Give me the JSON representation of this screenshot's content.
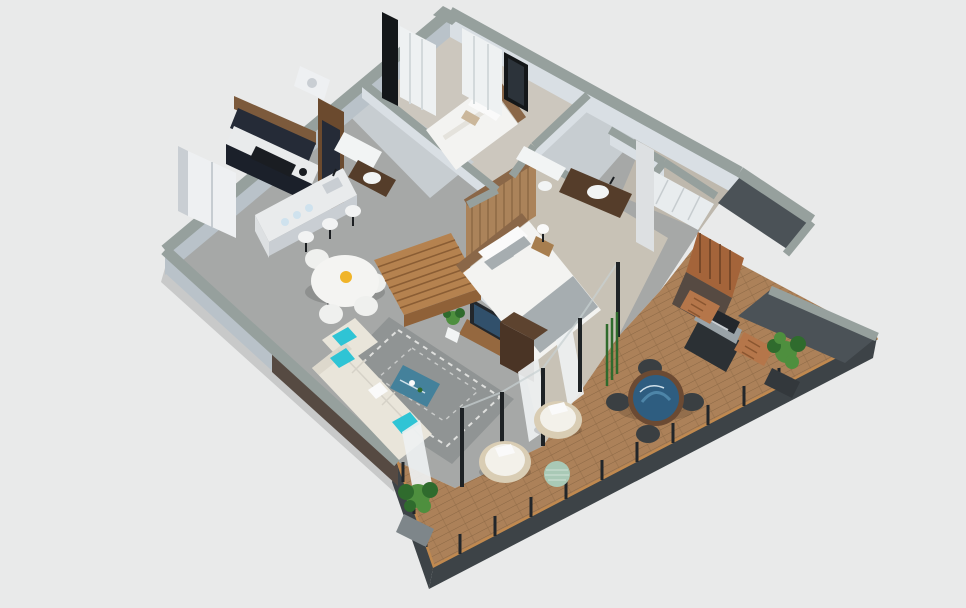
{
  "meta": {
    "title": "3D Floor Plan",
    "label": "Isometric 3D cutaway floor plan render of a two-bedroom apartment with a wraparound wooden terrace deck"
  },
  "colors": {
    "bg": "#e9eaea",
    "wallCap": "#96a09d",
    "wallFace": "#d9dfe4",
    "wallFaceShade": "#b9c2c9",
    "wallDark": "#4b5257",
    "floorGray": "#a6a8a7",
    "floorBeige": "#c8c2b6",
    "floorBeige2": "#ccc7be",
    "tile": "#c7cdd1",
    "closetFloor": "#beb8ad",
    "deckWood": "#ac8159",
    "deckPlank": "#8b6845",
    "deckRim": "#c0894f",
    "fascia": "#3d4347",
    "railPost": "#22262a",
    "glassPost": "#1e2225",
    "brick": "#564a42",
    "pergola": "#6e4226",
    "screenWood": "#a4643a",
    "curtain": "#eef1f2",
    "windowFrame": "#141719",
    "windowGlass": "#2c333a",
    "cabinetNavy": "#252b37",
    "cabinetNavyDark": "#1b202a",
    "cabinetWood": "#7c5a3c",
    "cabinetTall": "#6b4a2e",
    "counter": "#e9ebec",
    "marbleSide": "#dde0e2",
    "appliance": "#eef0f2",
    "applianceShade": "#c9ced3",
    "cooktop": "#1a1d22",
    "stoolWhite": "#f2f3f3",
    "tableWhite": "#f4f4f2",
    "chairWhite": "#eff0ee",
    "accentYellow": "#f0b429",
    "sofa": "#e9e5da",
    "sofaShade": "#ddd8cc",
    "pillowTeal": "#2fc4d5",
    "rug": "#909494",
    "rugLine": "#e8e8e6",
    "coffeeTable": "#44819b",
    "console": "#95683f",
    "tvDark": "#23272c",
    "tvScreen": "#31506b",
    "stairWood": "#b5824f",
    "stairSide": "#8f6138",
    "stairLine": "#8a5d34",
    "bedWhite": "#f3f3f1",
    "bedGray": "#a6adb0",
    "pillowWhite": "#fafafa",
    "pillowBeige": "#cbb79b",
    "headboard": "#8a6748",
    "slatWall": "#ab835a",
    "slatLine": "#7e5c3b",
    "bench": "#4a3425",
    "benchTop": "#5d432f",
    "nightstand": "#a77e4f",
    "vanity": "#553d2a",
    "sinkWhite": "#f2f4f4",
    "wardrobe": "#e8ecee",
    "mug": "#cfe2ee",
    "plantGreen": "#4e8f3e",
    "plantGreen2": "#2f6b2d",
    "planter": "#33383c",
    "planterGray": "#7e868a",
    "grillBody": "#2b3034",
    "grillSteel": "#9aa3a8",
    "sideTableWood": "#b5764a",
    "loungeRim": "#d9cdb4",
    "loungeCushion": "#f3f1ea",
    "pouf": "#a9c9b6",
    "deckTableTop": "#2e5d80",
    "deckTableTopLight": "#4d85a8",
    "deckTableRim": "#6b4a33",
    "deckChair": "#3a3f42",
    "shadow": "rgba(0,0,0,0.14)"
  },
  "scene": {
    "view": "isometric cutaway render",
    "rooms": [
      {
        "name": "kitchen",
        "items": [
          "refrigerator",
          "navy wall cabinets",
          "wood upper band",
          "cooktop counter",
          "tall cabinet column",
          "marble island with sink",
          "3 white bar stools",
          "blue mugs"
        ]
      },
      {
        "name": "dining-area",
        "items": [
          "round white table",
          "4 white tub chairs",
          "yellow centerpiece"
        ]
      },
      {
        "name": "living-room",
        "items": [
          "cream corner sofa",
          "teal accent pillows",
          "gray patterned rug",
          "blue glass coffee table",
          "wood tv console",
          "television",
          "potted plant",
          "sheer curtain"
        ]
      },
      {
        "name": "staircase",
        "items": [
          "wooden steps"
        ]
      },
      {
        "name": "master-bedroom",
        "items": [
          "double bed with gray runner",
          "wood slat headboard wall",
          "nightstand with lamp",
          "dark dresser",
          "sheer curtains"
        ]
      },
      {
        "name": "second-bedroom",
        "items": [
          "double bed",
          "wood headboard",
          "nightstand with lamp",
          "window curtains"
        ]
      },
      {
        "name": "bathroom-1",
        "items": [
          "bathtub",
          "wood vanity",
          "vessel sink"
        ]
      },
      {
        "name": "bathroom-2",
        "items": [
          "white counter",
          "toilet"
        ]
      },
      {
        "name": "ensuite-bathroom",
        "items": [
          "dark wood vanity",
          "vessel sink"
        ]
      },
      {
        "name": "walk-in-closet",
        "items": [
          "white wardrobe",
          "tall mirror door"
        ]
      },
      {
        "name": "terrace-deck",
        "items": [
          "round blue-glass dining table",
          "4 outdoor chairs",
          "bbq grill",
          "2 wood slat side tables",
          "2 round lounge chairs",
          "green pouf",
          "3 potted plants",
          "wood privacy screen",
          "brick wall",
          "pergola corner",
          "glass wall posts",
          "perimeter railing"
        ]
      }
    ]
  }
}
